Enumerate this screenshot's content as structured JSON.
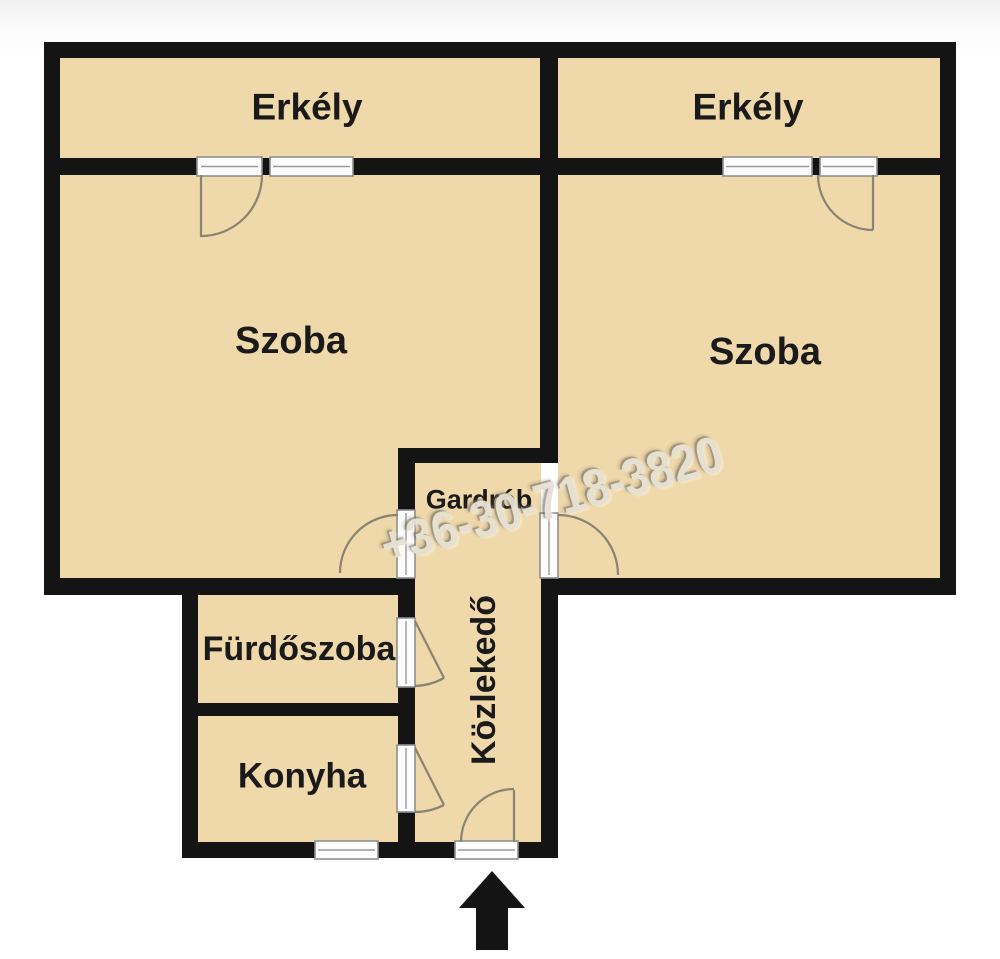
{
  "plan": {
    "type": "apartment-floor-plan",
    "rooms": {
      "balcony_left": {
        "label": "Erkély"
      },
      "balcony_right": {
        "label": "Erkély"
      },
      "room_left": {
        "label": "Szoba"
      },
      "room_right": {
        "label": "Szoba"
      },
      "wardrobe": {
        "label": "Gardrób"
      },
      "hallway": {
        "label": "Közlekedő"
      },
      "bathroom": {
        "label": "Fürdőszoba"
      },
      "kitchen": {
        "label": "Konyha"
      }
    },
    "entrance_marker": "arrow-up"
  },
  "watermark": {
    "text": "+36-30-718-3820"
  },
  "colors": {
    "room_fill": "#efd8a9",
    "wall": "#141414",
    "door_arc": "#8a8372",
    "watermark_fill": "#e6e1d3"
  }
}
